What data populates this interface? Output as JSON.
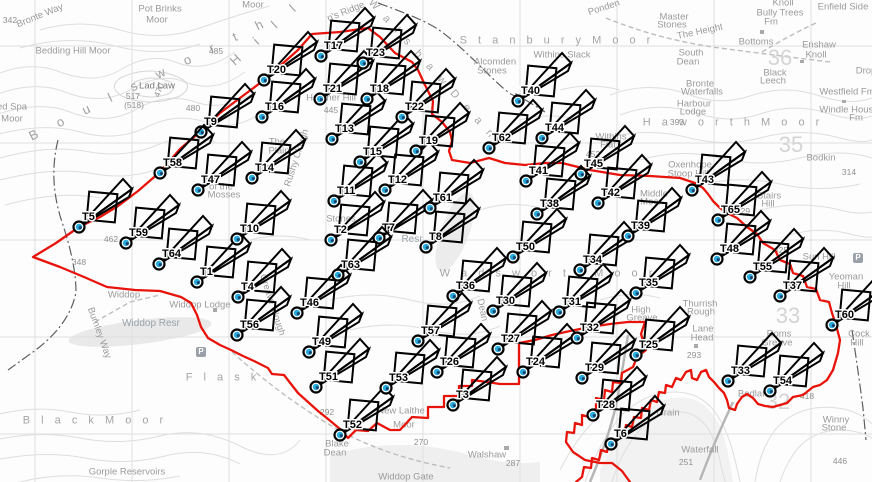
{
  "map": {
    "name": "Walshaw Moor wind farm layout map",
    "colors": {
      "boundary": "#e8140b",
      "marker_stroke": "#000000",
      "hub_fill": "#29aadd",
      "hub_dark": "#1b3f66"
    }
  },
  "turbines": [
    {
      "id": "T1",
      "x": 197,
      "y": 282
    },
    {
      "id": "T2",
      "x": 331,
      "y": 240
    },
    {
      "id": "T3",
      "x": 453,
      "y": 405
    },
    {
      "id": "T4",
      "x": 238,
      "y": 297
    },
    {
      "id": "T5",
      "x": 79,
      "y": 227
    },
    {
      "id": "T6",
      "x": 611,
      "y": 444
    },
    {
      "id": "T7",
      "x": 379,
      "y": 238
    },
    {
      "id": "T8",
      "x": 426,
      "y": 247
    },
    {
      "id": "T9",
      "x": 201,
      "y": 132
    },
    {
      "id": "T10",
      "x": 237,
      "y": 239
    },
    {
      "id": "T11",
      "x": 334,
      "y": 201
    },
    {
      "id": "T12",
      "x": 385,
      "y": 190
    },
    {
      "id": "T13",
      "x": 332,
      "y": 139
    },
    {
      "id": "T14",
      "x": 252,
      "y": 178
    },
    {
      "id": "T15",
      "x": 360,
      "y": 162
    },
    {
      "id": "T16",
      "x": 262,
      "y": 117
    },
    {
      "id": "T17",
      "x": 321,
      "y": 56
    },
    {
      "id": "T18",
      "x": 367,
      "y": 99
    },
    {
      "id": "T19",
      "x": 416,
      "y": 151
    },
    {
      "id": "T20",
      "x": 264,
      "y": 80
    },
    {
      "id": "T21",
      "x": 320,
      "y": 99
    },
    {
      "id": "T22",
      "x": 402,
      "y": 117
    },
    {
      "id": "T23",
      "x": 363,
      "y": 63
    },
    {
      "id": "T24",
      "x": 523,
      "y": 372
    },
    {
      "id": "T25",
      "x": 636,
      "y": 355
    },
    {
      "id": "T26",
      "x": 437,
      "y": 372
    },
    {
      "id": "T27",
      "x": 498,
      "y": 349
    },
    {
      "id": "T28",
      "x": 593,
      "y": 415
    },
    {
      "id": "T29",
      "x": 582,
      "y": 378
    },
    {
      "id": "T30",
      "x": 493,
      "y": 311
    },
    {
      "id": "T31",
      "x": 559,
      "y": 312
    },
    {
      "id": "T32",
      "x": 577,
      "y": 338
    },
    {
      "id": "T33",
      "x": 728,
      "y": 381
    },
    {
      "id": "T34",
      "x": 580,
      "y": 270
    },
    {
      "id": "T35",
      "x": 636,
      "y": 293
    },
    {
      "id": "T36",
      "x": 453,
      "y": 296
    },
    {
      "id": "T37",
      "x": 780,
      "y": 296
    },
    {
      "id": "T38",
      "x": 537,
      "y": 214
    },
    {
      "id": "T39",
      "x": 628,
      "y": 236
    },
    {
      "id": "T40",
      "x": 518,
      "y": 101
    },
    {
      "id": "T41",
      "x": 526,
      "y": 181
    },
    {
      "id": "T42",
      "x": 598,
      "y": 203
    },
    {
      "id": "T43",
      "x": 692,
      "y": 190
    },
    {
      "id": "T44",
      "x": 542,
      "y": 138
    },
    {
      "id": "T45",
      "x": 581,
      "y": 174
    },
    {
      "id": "T46",
      "x": 297,
      "y": 313
    },
    {
      "id": "T47",
      "x": 198,
      "y": 190
    },
    {
      "id": "T48",
      "x": 717,
      "y": 259
    },
    {
      "id": "T49",
      "x": 309,
      "y": 352
    },
    {
      "id": "T50",
      "x": 513,
      "y": 257
    },
    {
      "id": "T51",
      "x": 316,
      "y": 387
    },
    {
      "id": "T52",
      "x": 340,
      "y": 435
    },
    {
      "id": "T53",
      "x": 386,
      "y": 388
    },
    {
      "id": "T54",
      "x": 770,
      "y": 391
    },
    {
      "id": "T55",
      "x": 750,
      "y": 277
    },
    {
      "id": "T56",
      "x": 237,
      "y": 335
    },
    {
      "id": "T57",
      "x": 418,
      "y": 341
    },
    {
      "id": "T58",
      "x": 160,
      "y": 173
    },
    {
      "id": "T59",
      "x": 126,
      "y": 243
    },
    {
      "id": "T60",
      "x": 832,
      "y": 325
    },
    {
      "id": "T61",
      "x": 430,
      "y": 208
    },
    {
      "id": "T62",
      "x": 489,
      "y": 148
    },
    {
      "id": "T63",
      "x": 338,
      "y": 275
    },
    {
      "id": "T64",
      "x": 159,
      "y": 264
    },
    {
      "id": "T65",
      "x": 718,
      "y": 220
    }
  ],
  "boundary": {
    "west": "368,28 340,32 312,34 298,50 264,80 240,98 220,113 201,131 180,149 160,172 138,191 118,206 100,217 79,227 56,243 33,257 60,267 84,277 107,287 135,290 160,291 181,297 191,303 197,315 201,327 208,338 220,345 231,350 243,356 254,361 268,368 272,374 284,375 291,384 298,393 308,402 318,411 328,419 340,429 348,438 356,430 368,431 377,423 390,430 400,430 412,417 428,418 428,407 444,407 444,396 459,396 459,386 472,386 472,380 487,382 500,384 519,384 519,343 535,340 552,335 570,331 590,327 610,324 628,322 645,322 641,334 646,350 637,357 633,367 622,373 621,383 613,382 612,392 605,390 604,400 596,398 596,408 589,417 582,415 582,425 575,423 574,433 567,432 566,442 573,452 585,460 600,463 612,463 622,471 630,482",
    "east": "368,28 380,37 395,53 412,62 418,70 424,83 429,93 433,101 432,114 442,122 450,132 452,141 449,151 452,160 470,163 489,158 505,163 525,165 545,163 562,163 590,170 620,175 650,176 680,178 695,183 703,188 708,194 713,201 720,208 727,213 737,218 747,227 757,234 763,243 775,250 780,260 790,264 793,273 803,276 807,287 816,289 820,300 829,302 832,313 836,325 840,340 838,353 833,370 827,380 820,385 813,387 803,395 793,397 787,403 780,405 773,407 765,406 758,404 753,398 747,394 742,397 737,404 735,410 729,408 727,400 724,393 719,388 714,382 709,377 706,370 701,372 697,380 692,378 691,370 686,372 681,380 676,378 672,387 666,385 665,393 659,392 657,402 651,400 649,410 642,408 641,418 634,417 632,427 626,425 624,435 617,433 616,443 609,442 607,452 601,450 599,460 592,458 591,468 584,467 582,477 576,482"
  },
  "grid": {
    "vlines": [
      35,
      132,
      229,
      326,
      423,
      520,
      617,
      714,
      811
    ],
    "hlines": [
      46,
      143,
      240,
      337,
      434
    ]
  },
  "labels": [
    {
      "t": "342",
      "x": 10,
      "y": 20,
      "cls": "pl-num"
    },
    {
      "t": "Bronte Way",
      "x": 40,
      "y": 16,
      "rot": -22
    },
    {
      "t": "Pot Brinks",
      "x": 160,
      "y": 9
    },
    {
      "t": "Moor",
      "x": 157,
      "y": 20
    },
    {
      "t": "Moor",
      "x": 253,
      "y": 5
    },
    {
      "t": "Bedding Hill Moor",
      "x": 73,
      "y": 51
    },
    {
      "t": "ed Spa",
      "x": 12,
      "y": 107
    },
    {
      "t": "Moor",
      "x": 12,
      "y": 119
    },
    {
      "t": "B o u l s w o r t h",
      "x": 150,
      "y": 78,
      "cls": "pl-huge",
      "rot": -26
    },
    {
      "t": "H i l l",
      "x": 266,
      "y": 32,
      "cls": "pl-huge",
      "rot": -42
    },
    {
      "t": "Lad Law",
      "x": 157,
      "y": 86,
      "cls": "pl-dark"
    },
    {
      "t": "517",
      "x": 133,
      "y": 96,
      "cls": "pl-num"
    },
    {
      "t": "(518)",
      "x": 134,
      "y": 105,
      "cls": "pl-num"
    },
    {
      "t": "485",
      "x": 216,
      "y": 51,
      "cls": "pl-num"
    },
    {
      "t": "480",
      "x": 193,
      "y": 108,
      "cls": "pl-num"
    },
    {
      "t": "470",
      "x": 159,
      "y": 90,
      "cls": "pl-num",
      "rot": -70
    },
    {
      "t": "S t a n b u r y   M o o r",
      "x": 557,
      "y": 41,
      "cls": "pl-sp"
    },
    {
      "t": "Withins Slack",
      "x": 562,
      "y": 55
    },
    {
      "t": "Alcomden",
      "x": 495,
      "y": 62
    },
    {
      "t": "Stones",
      "x": 492,
      "y": 71
    },
    {
      "t": "Ponden",
      "x": 604,
      "y": 8,
      "rot": -18
    },
    {
      "t": "Master",
      "x": 674,
      "y": 17
    },
    {
      "t": "Stones",
      "x": 672,
      "y": 25
    },
    {
      "t": "The Height",
      "x": 700,
      "y": 32,
      "rot": -12
    },
    {
      "t": "South",
      "x": 691,
      "y": 53
    },
    {
      "t": "Dean",
      "x": 688,
      "y": 62
    },
    {
      "t": "Bully Trees",
      "x": 780,
      "y": 13
    },
    {
      "t": "Fm",
      "x": 771,
      "y": 22
    },
    {
      "t": "Knoll",
      "x": 783,
      "y": 3
    },
    {
      "t": "Enfield Side",
      "x": 843,
      "y": 7
    },
    {
      "t": "Bottoms",
      "x": 756,
      "y": 42
    },
    {
      "t": "Enshaw",
      "x": 819,
      "y": 45
    },
    {
      "t": "Knoll",
      "x": 816,
      "y": 55
    },
    {
      "t": "Black",
      "x": 775,
      "y": 73
    },
    {
      "t": "Leech",
      "x": 773,
      "y": 81
    },
    {
      "t": "Drop",
      "x": 866,
      "y": 71
    },
    {
      "t": "Westfield Fm",
      "x": 847,
      "y": 92
    },
    {
      "t": "Windle House",
      "x": 849,
      "y": 110
    },
    {
      "t": "Fm",
      "x": 856,
      "y": 118
    },
    {
      "t": "Bronte",
      "x": 700,
      "y": 84
    },
    {
      "t": "Waterfalls",
      "x": 702,
      "y": 92
    },
    {
      "t": "Harbour",
      "x": 694,
      "y": 104
    },
    {
      "t": "Lodge",
      "x": 693,
      "y": 112
    },
    {
      "t": "393",
      "x": 677,
      "y": 122,
      "cls": "pl-num"
    },
    {
      "t": "H a w o r t h   M o o r",
      "x": 733,
      "y": 123,
      "cls": "pl-sp"
    },
    {
      "t": "Bodkin",
      "x": 821,
      "y": 158
    },
    {
      "t": "314",
      "x": 849,
      "y": 172,
      "cls": "pl-num"
    },
    {
      "t": "Oxenhope",
      "x": 690,
      "y": 165
    },
    {
      "t": "Stoop Hill",
      "x": 688,
      "y": 174
    },
    {
      "t": "Stairs",
      "x": 769,
      "y": 196
    },
    {
      "t": "Hill",
      "x": 768,
      "y": 204
    },
    {
      "t": "429",
      "x": 743,
      "y": 211,
      "cls": "pl-num"
    },
    {
      "t": "Middle",
      "x": 654,
      "y": 194
    },
    {
      "t": "Moor",
      "x": 651,
      "y": 202
    },
    {
      "t": "Withins",
      "x": 611,
      "y": 137
    },
    {
      "t": "Flat",
      "x": 608,
      "y": 145
    },
    {
      "t": "452",
      "x": 593,
      "y": 154,
      "cls": "pl-num"
    },
    {
      "t": "Sun Hill",
      "x": 819,
      "y": 257
    },
    {
      "t": "425",
      "x": 781,
      "y": 250,
      "cls": "pl-num"
    },
    {
      "t": "Yeoman",
      "x": 846,
      "y": 277
    },
    {
      "t": "Hill",
      "x": 844,
      "y": 286
    },
    {
      "t": "Roms",
      "x": 779,
      "y": 334
    },
    {
      "t": "Greave",
      "x": 777,
      "y": 343
    },
    {
      "t": "Cock",
      "x": 859,
      "y": 334
    },
    {
      "t": "Hill",
      "x": 857,
      "y": 343
    },
    {
      "t": "Lane",
      "x": 703,
      "y": 329
    },
    {
      "t": "Head",
      "x": 702,
      "y": 338
    },
    {
      "t": "293",
      "x": 694,
      "y": 355,
      "cls": "pl-num"
    },
    {
      "t": "Thurrish",
      "x": 700,
      "y": 304
    },
    {
      "t": "Rough",
      "x": 701,
      "y": 312
    },
    {
      "t": "High",
      "x": 641,
      "y": 310
    },
    {
      "t": "Greave",
      "x": 642,
      "y": 318
    },
    {
      "t": "Winny",
      "x": 836,
      "y": 420
    },
    {
      "t": "Stone",
      "x": 834,
      "y": 428
    },
    {
      "t": "446",
      "x": 840,
      "y": 461,
      "cls": "pl-num"
    },
    {
      "t": "418",
      "x": 807,
      "y": 396,
      "cls": "pl-num"
    },
    {
      "t": "Bedlam",
      "x": 754,
      "y": 394
    },
    {
      "t": "Grain",
      "x": 668,
      "y": 413
    },
    {
      "t": "Waterfall",
      "x": 700,
      "y": 450
    },
    {
      "t": "251",
      "x": 686,
      "y": 462,
      "cls": "pl-num"
    },
    {
      "t": "Walshaw",
      "x": 487,
      "y": 455
    },
    {
      "t": "287",
      "x": 513,
      "y": 463,
      "cls": "pl-num"
    },
    {
      "t": "Widdop Gate",
      "x": 406,
      "y": 477
    },
    {
      "t": "New Laithe",
      "x": 401,
      "y": 411
    },
    {
      "t": "Moor",
      "x": 404,
      "y": 425
    },
    {
      "t": "Blake",
      "x": 337,
      "y": 444
    },
    {
      "t": "Dean",
      "x": 335,
      "y": 453
    },
    {
      "t": "292",
      "x": 327,
      "y": 412,
      "cls": "pl-num"
    },
    {
      "t": "270",
      "x": 421,
      "y": 442,
      "cls": "pl-num"
    },
    {
      "t": "Gorple Reservoirs",
      "x": 127,
      "y": 472
    },
    {
      "t": "B l a c k   M o o r",
      "x": 95,
      "y": 421,
      "cls": "pl-sp"
    },
    {
      "t": "F l a s k",
      "x": 223,
      "y": 378,
      "cls": "pl-sp"
    },
    {
      "t": "Widdop Resr",
      "x": 151,
      "y": 324,
      "cls": "water"
    },
    {
      "t": "Widdop",
      "x": 124,
      "y": 295
    },
    {
      "t": "Widdop Lodge",
      "x": 200,
      "y": 305
    },
    {
      "t": "348",
      "x": 79,
      "y": 262,
      "cls": "pl-num"
    },
    {
      "t": "462",
      "x": 111,
      "y": 239,
      "cls": "pl-num"
    },
    {
      "t": "Burnley Way",
      "x": 99,
      "y": 333,
      "rot": 70
    },
    {
      "t": "Rushy Clough",
      "x": 297,
      "y": 158,
      "rot": -72
    },
    {
      "t": "Heather Hill",
      "x": 331,
      "y": 98
    },
    {
      "t": "445",
      "x": 331,
      "y": 110,
      "cls": "pl-num"
    },
    {
      "t": "n's Ridge",
      "x": 346,
      "y": 12,
      "rot": -22
    },
    {
      "t": "W a l s h a w   D e a n",
      "x": 432,
      "y": 70,
      "cls": "pl-sp",
      "rot": 48
    },
    {
      "t": "The",
      "x": 277,
      "y": 142
    },
    {
      "t": "Plain",
      "x": 279,
      "y": 151
    },
    {
      "t": "of the",
      "x": 221,
      "y": 187
    },
    {
      "t": "Mosses",
      "x": 224,
      "y": 195
    },
    {
      "t": "W a d s w o r t h   M o o r",
      "x": 548,
      "y": 274,
      "cls": "pl-sp"
    },
    {
      "t": "Stones",
      "x": 341,
      "y": 219
    },
    {
      "t": "Resr",
      "x": 412,
      "y": 240,
      "cls": "water"
    },
    {
      "t": "Dean",
      "x": 482,
      "y": 310,
      "rot": 78
    },
    {
      "t": "Greave Clough",
      "x": 272,
      "y": 305,
      "rot": 72
    },
    {
      "t": "36",
      "x": 780,
      "y": 58,
      "cls": "grid-num"
    },
    {
      "t": "35",
      "x": 791,
      "y": 145,
      "cls": "grid-num"
    },
    {
      "t": "33",
      "x": 788,
      "y": 316,
      "cls": "grid-num"
    },
    {
      "t": "32",
      "x": 778,
      "y": 402,
      "cls": "grid-num"
    }
  ],
  "parking": [
    {
      "x": 201,
      "y": 352
    },
    {
      "x": 858,
      "y": 258
    }
  ]
}
